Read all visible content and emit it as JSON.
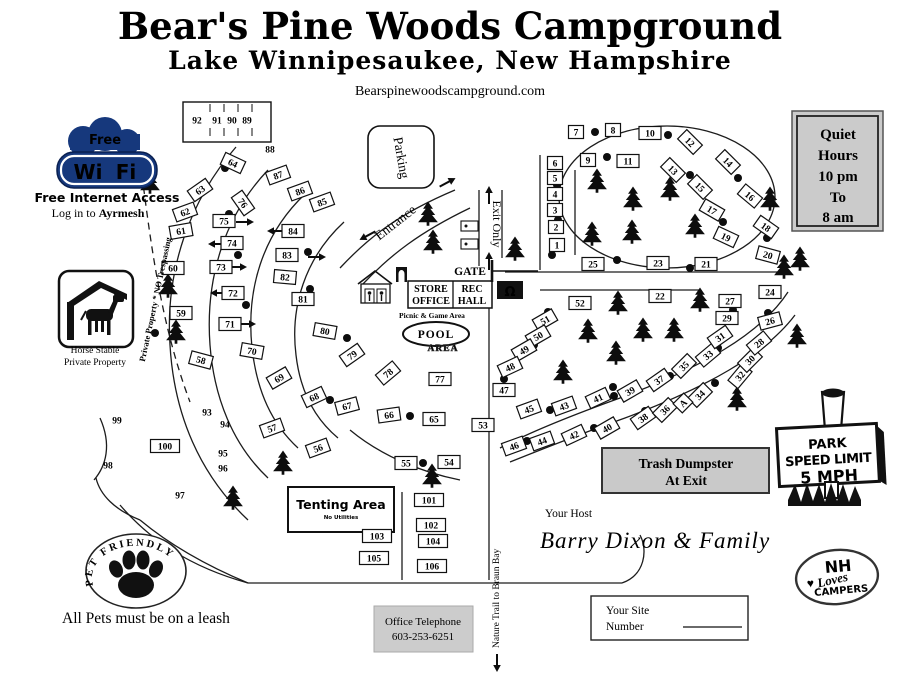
{
  "header": {
    "title": "Bear's Pine Woods Campground",
    "subtitle": "Lake Winnipesaukee, New Hampshire",
    "website": "Bearspinewoodscampground.com"
  },
  "wifi_badge": {
    "cloud": "Free",
    "wi": "Wi",
    "fi": "Fi",
    "tagline": "Free Internet Access",
    "login_prefix": "Log in to ",
    "login_name": "Ayrmesh",
    "blue": "#16387c"
  },
  "stable_badge": {
    "line1": "Horse Stable",
    "line2": "Private Property"
  },
  "pet_badge": {
    "arc_text": "PET FRIENDLY",
    "rule": "All Pets must be on a leash"
  },
  "quiet_hours": {
    "lines": [
      "Quiet",
      "Hours",
      "10 pm",
      "To",
      "8 am"
    ]
  },
  "speed_sign": {
    "lines": [
      "PARK",
      "SPEED LIMIT",
      "5 MPH"
    ]
  },
  "trash_notice": {
    "line1": "Trash Dumpster",
    "line2": "At Exit"
  },
  "office_phone": {
    "line1": "Office Telephone",
    "line2": "603-253-6251"
  },
  "host": {
    "label": "Your Host",
    "name": "Barry Dixon & Family"
  },
  "site_number_card": {
    "line1": "Your Site",
    "line2": "Number"
  },
  "nh_badge": {
    "top": "NH",
    "script": "Loves",
    "bottom": "CAMPERS",
    "heart": "♥",
    "accent": "#c1272d"
  },
  "nature_trail_label": "Nature Trail to Braun Bay",
  "colors": {
    "wifi_blue": "#16387c",
    "sign_gray": "#cbcbcb",
    "accent_red": "#c1272d"
  },
  "map": {
    "labels": {
      "parking": "Parking",
      "entrance": "Entrance",
      "exit": "Exit Only",
      "gate": "GATE",
      "store1": "STORE",
      "store2": "OFFICE",
      "rec1": "REC",
      "rec2": "HALL",
      "picnic": "Picnic & Game Area",
      "pool": "POOL",
      "pool_area": "AREA",
      "tenting": "Tenting Area",
      "tenting_sub": "No Utilities",
      "boundary": "Private Property * NO Trespassing",
      "omega": "Ω"
    },
    "sites": [
      [
        "92",
        197,
        120,
        0,
        0
      ],
      [
        "91",
        217,
        120,
        0,
        0
      ],
      [
        "90",
        232,
        120,
        0,
        0
      ],
      [
        "89",
        247,
        120,
        0,
        0
      ],
      [
        "88",
        270,
        149,
        0,
        0
      ],
      [
        "87",
        278,
        175,
        -20,
        1
      ],
      [
        "86",
        300,
        191,
        -20,
        1
      ],
      [
        "85",
        322,
        202,
        -20,
        1
      ],
      [
        "64",
        233,
        163,
        25,
        1
      ],
      [
        "63",
        200,
        190,
        -35,
        1
      ],
      [
        "62",
        185,
        212,
        -20,
        1
      ],
      [
        "61",
        181,
        231,
        -10,
        1
      ],
      [
        "60",
        173,
        268,
        0,
        1
      ],
      [
        "59",
        181,
        313,
        0,
        1
      ],
      [
        "58",
        201,
        360,
        15,
        1
      ],
      [
        "76",
        243,
        203,
        55,
        1
      ],
      [
        "75",
        224,
        221,
        0,
        1
      ],
      [
        "74",
        232,
        243,
        0,
        1
      ],
      [
        "73",
        221,
        267,
        0,
        1
      ],
      [
        "72",
        233,
        293,
        0,
        1
      ],
      [
        "71",
        230,
        324,
        0,
        1
      ],
      [
        "70",
        252,
        351,
        10,
        1
      ],
      [
        "69",
        279,
        378,
        -30,
        1
      ],
      [
        "68",
        314,
        397,
        -25,
        1
      ],
      [
        "67",
        347,
        406,
        -15,
        1
      ],
      [
        "66",
        389,
        415,
        -8,
        1
      ],
      [
        "65",
        434,
        419,
        0,
        1
      ],
      [
        "84",
        293,
        231,
        0,
        1
      ],
      [
        "83",
        287,
        255,
        0,
        1
      ],
      [
        "82",
        285,
        277,
        5,
        1
      ],
      [
        "81",
        303,
        299,
        0,
        1
      ],
      [
        "80",
        325,
        331,
        10,
        1
      ],
      [
        "79",
        352,
        355,
        -35,
        1
      ],
      [
        "78",
        388,
        373,
        -40,
        1
      ],
      [
        "77",
        440,
        379,
        0,
        1
      ],
      [
        "93",
        207,
        412,
        0,
        0
      ],
      [
        "94",
        225,
        424,
        0,
        0
      ],
      [
        "95",
        223,
        453,
        0,
        0
      ],
      [
        "96",
        223,
        468,
        0,
        0
      ],
      [
        "97",
        180,
        495,
        0,
        0
      ],
      [
        "98",
        108,
        465,
        0,
        0
      ],
      [
        "99",
        117,
        420,
        0,
        0
      ],
      [
        "100",
        165,
        446,
        0,
        1
      ],
      [
        "101",
        429,
        500,
        0,
        1
      ],
      [
        "102",
        431,
        525,
        0,
        1
      ],
      [
        "103",
        377,
        536,
        0,
        1
      ],
      [
        "104",
        433,
        541,
        0,
        1
      ],
      [
        "105",
        374,
        558,
        0,
        1
      ],
      [
        "106",
        432,
        566,
        0,
        1
      ],
      [
        "57",
        272,
        428,
        -20,
        1
      ],
      [
        "56",
        318,
        448,
        -20,
        1
      ],
      [
        "55",
        406,
        463,
        0,
        1
      ],
      [
        "54",
        449,
        462,
        0,
        1
      ],
      [
        "53",
        483,
        425,
        0,
        1
      ],
      [
        "52",
        580,
        303,
        0,
        1
      ],
      [
        "51",
        545,
        320,
        -30,
        1
      ],
      [
        "50",
        538,
        336,
        -30,
        1
      ],
      [
        "49",
        524,
        350,
        -30,
        1
      ],
      [
        "48",
        510,
        367,
        -25,
        1
      ],
      [
        "47",
        504,
        390,
        0,
        1
      ],
      [
        "46",
        514,
        446,
        -20,
        1
      ],
      [
        "45",
        529,
        409,
        -20,
        1
      ],
      [
        "44",
        542,
        441,
        -20,
        1
      ],
      [
        "43",
        564,
        406,
        -20,
        1
      ],
      [
        "42",
        574,
        435,
        -25,
        1
      ],
      [
        "41",
        598,
        398,
        -25,
        1
      ],
      [
        "40",
        607,
        428,
        -30,
        1
      ],
      [
        "39",
        630,
        391,
        -30,
        1
      ],
      [
        "38",
        643,
        418,
        -35,
        1
      ],
      [
        "37",
        659,
        380,
        -35,
        1
      ],
      [
        "36",
        665,
        410,
        -45,
        1
      ],
      [
        "35",
        684,
        366,
        -45,
        1
      ],
      [
        "34",
        700,
        395,
        -45,
        1
      ],
      [
        "33",
        708,
        355,
        -40,
        1
      ],
      [
        "32",
        740,
        376,
        -50,
        1
      ],
      [
        "31",
        720,
        337,
        -35,
        1
      ],
      [
        "30",
        750,
        360,
        -45,
        1
      ],
      [
        "29",
        727,
        318,
        0,
        1
      ],
      [
        "28",
        759,
        343,
        -40,
        1
      ],
      [
        "27",
        730,
        301,
        0,
        1
      ],
      [
        "26",
        770,
        321,
        -15,
        1
      ],
      [
        "A",
        683,
        403,
        -45,
        1
      ],
      [
        "25",
        593,
        264,
        0,
        1
      ],
      [
        "24",
        770,
        292,
        0,
        1
      ],
      [
        "23",
        658,
        263,
        0,
        1
      ],
      [
        "22",
        660,
        296,
        0,
        1
      ],
      [
        "21",
        706,
        264,
        0,
        1
      ],
      [
        "20",
        768,
        255,
        15,
        1
      ],
      [
        "19",
        726,
        237,
        25,
        1
      ],
      [
        "18",
        766,
        227,
        35,
        1
      ],
      [
        "17",
        712,
        210,
        30,
        1
      ],
      [
        "16",
        750,
        196,
        40,
        1
      ],
      [
        "15",
        700,
        187,
        45,
        1
      ],
      [
        "14",
        728,
        162,
        45,
        1
      ],
      [
        "13",
        673,
        170,
        45,
        1
      ],
      [
        "12",
        690,
        142,
        45,
        1
      ],
      [
        "11",
        628,
        161,
        0,
        1
      ],
      [
        "10",
        650,
        133,
        0,
        1
      ],
      [
        "9",
        588,
        160,
        0,
        1
      ],
      [
        "8",
        613,
        130,
        0,
        1
      ],
      [
        "7",
        576,
        132,
        0,
        1
      ],
      [
        "6",
        555,
        163,
        0,
        1
      ],
      [
        "5",
        555,
        178,
        0,
        1
      ],
      [
        "4",
        555,
        194,
        0,
        1
      ],
      [
        "3",
        555,
        210,
        0,
        1
      ],
      [
        "2",
        556,
        227,
        0,
        1
      ],
      [
        "1",
        557,
        245,
        0,
        1
      ]
    ],
    "trees": [
      [
        150,
        183
      ],
      [
        168,
        287
      ],
      [
        176,
        333
      ],
      [
        283,
        464
      ],
      [
        233,
        499
      ],
      [
        428,
        215
      ],
      [
        433,
        243
      ],
      [
        515,
        250
      ],
      [
        597,
        182
      ],
      [
        633,
        200
      ],
      [
        670,
        190
      ],
      [
        592,
        235
      ],
      [
        632,
        233
      ],
      [
        695,
        227
      ],
      [
        770,
        200
      ],
      [
        784,
        268
      ],
      [
        618,
        304
      ],
      [
        700,
        301
      ],
      [
        643,
        331
      ],
      [
        674,
        331
      ],
      [
        616,
        354
      ],
      [
        563,
        373
      ],
      [
        588,
        332
      ],
      [
        800,
        260
      ],
      [
        797,
        337
      ],
      [
        737,
        400
      ],
      [
        432,
        477
      ]
    ],
    "hookup_dots": [
      [
        225,
        168
      ],
      [
        229,
        214
      ],
      [
        238,
        255
      ],
      [
        308,
        252
      ],
      [
        246,
        305
      ],
      [
        310,
        289
      ],
      [
        155,
        333
      ],
      [
        347,
        338
      ],
      [
        330,
        400
      ],
      [
        410,
        416
      ],
      [
        534,
        345
      ],
      [
        504,
        379
      ],
      [
        614,
        396
      ],
      [
        594,
        428
      ],
      [
        527,
        441
      ],
      [
        645,
        411
      ],
      [
        550,
        410
      ],
      [
        548,
        312
      ],
      [
        617,
        260
      ],
      [
        690,
        268
      ],
      [
        733,
        310
      ],
      [
        768,
        313
      ],
      [
        718,
        348
      ],
      [
        670,
        376
      ],
      [
        613,
        387
      ],
      [
        715,
        383
      ],
      [
        595,
        132
      ],
      [
        668,
        135
      ],
      [
        607,
        157
      ],
      [
        690,
        175
      ],
      [
        738,
        178
      ],
      [
        557,
        185
      ],
      [
        558,
        220
      ],
      [
        552,
        255
      ],
      [
        723,
        222
      ],
      [
        767,
        238
      ],
      [
        423,
        463
      ]
    ],
    "arrows": [
      [
        452,
        180,
        -28
      ],
      [
        363,
        238,
        152
      ],
      [
        489,
        190,
        -90
      ],
      [
        489,
        256,
        -90
      ],
      [
        250,
        222,
        0
      ],
      [
        271,
        231,
        180
      ],
      [
        212,
        244,
        180
      ],
      [
        243,
        267,
        0
      ],
      [
        322,
        257,
        0
      ],
      [
        214,
        293,
        180
      ],
      [
        252,
        324,
        0
      ],
      [
        497,
        668,
        90
      ]
    ]
  }
}
